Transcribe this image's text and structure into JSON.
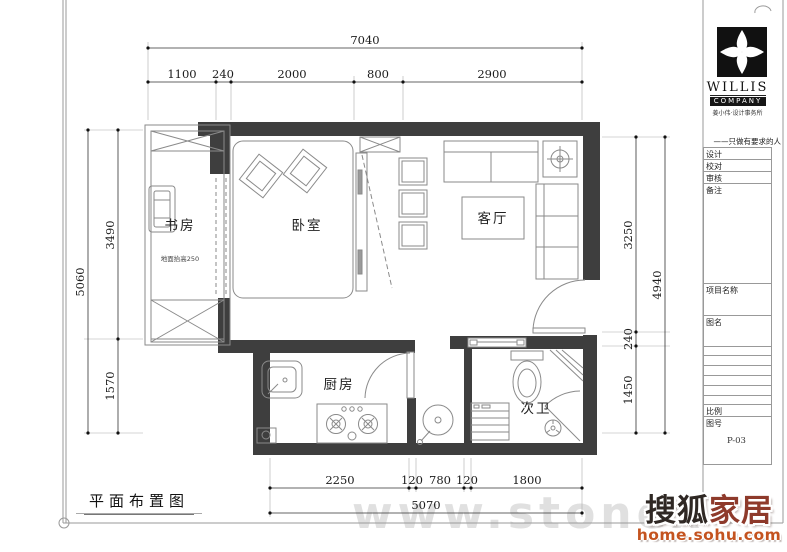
{
  "dims": {
    "top": {
      "total": "7040",
      "segs": [
        "1100",
        "240",
        "2000",
        "800",
        "2900"
      ]
    },
    "left": {
      "total": "5060",
      "segs": [
        "3490",
        "1570"
      ]
    },
    "right": {
      "total": "4940",
      "segs": [
        "3250",
        "240",
        "1450"
      ]
    },
    "bottom": {
      "total": "5070",
      "segs": [
        "2250",
        "120",
        "780",
        "120",
        "1800"
      ]
    }
  },
  "rooms": {
    "study": "书房",
    "study_note": "地面抬高250",
    "bedroom": "卧室",
    "living": "客厅",
    "kitchen": "厨房",
    "bath": "次卫"
  },
  "plan_title": "平面布置图",
  "title_block": {
    "brand_top": "WILLIS",
    "brand_bottom": "COMPANY",
    "brand_sub": "姜小伟·设计事务所",
    "slogan": "——只做有要求的人",
    "fields": {
      "design": "设计",
      "proof": "校对",
      "review": "审核",
      "remark": "备注",
      "project": "项目名称",
      "drawing": "图名",
      "scale": "比例",
      "number": "图号"
    },
    "drawing_no": "P-03"
  },
  "watermark": "www.stonex",
  "sohu": {
    "brand_dark": "搜狐",
    "brand_red": "家居",
    "url": "home.sohu.com"
  },
  "colors": {
    "wall": "#3e3e3e",
    "sohu_red": "#8e3a2b",
    "sohu_orange": "#c4531f"
  }
}
